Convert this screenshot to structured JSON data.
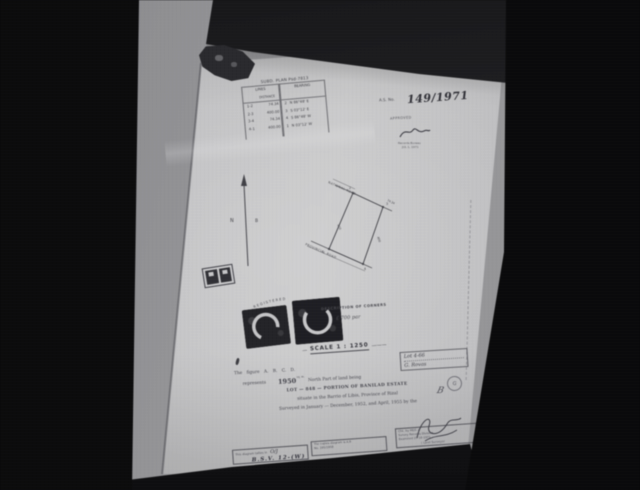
{
  "colors": {
    "paper": "#c2c2c4",
    "backdrop": "#8f8f92",
    "ink": "#3a3a40",
    "photo_black": "#060607",
    "seal_ink": "#1d1d21"
  },
  "table": {
    "title": "SUBD. PLAN Psd-7813",
    "group_headers": [
      "LINES",
      "BEARING"
    ],
    "sub_header": "DISTANCE",
    "rows": [
      {
        "line": "1-2",
        "distance": "74.34",
        "n": "2",
        "bearing": "N 86°48' E"
      },
      {
        "line": "2-3",
        "distance": "400.00",
        "n": "3",
        "bearing": "S 03°12' E"
      },
      {
        "line": "3-4",
        "distance": "74.34",
        "n": "4",
        "bearing": "S 86°48' W"
      },
      {
        "line": "4-1",
        "distance": "400.00",
        "n": "1",
        "bearing": "N 03°12' W"
      }
    ]
  },
  "approval": {
    "as_label": "A.S. No.",
    "as_number": "149/1971",
    "approved": "APPROVED",
    "bureau": "Records Bureau",
    "date": "JUL 1, 1971"
  },
  "north": {
    "left_mark": "N",
    "right_mark": "B"
  },
  "parcel": {
    "road_top": "NATIONAL ROAD",
    "road_bottom": "PROVINCIAL ROAD",
    "side_left": "400",
    "side_right": "400",
    "top_width": "74.34",
    "corners": {
      "tl": "2",
      "tr": "3",
      "bl": "1",
      "br": "4"
    }
  },
  "seals": {
    "arc_text": "REGISTERED"
  },
  "description": {
    "heading": "DESCRIPTION OF CORNERS",
    "note": "£ 700 par"
  },
  "scale": {
    "dash_left": "—",
    "text": "SCALE 1 : 1250",
    "dash_right": "———"
  },
  "lot_box": {
    "line1": "Lot  4-66",
    "line2": "G. Rovas"
  },
  "body": {
    "l1": "The figure  A. B. C. D.",
    "l2_pre": "represents",
    "l2_area": "1950",
    "l2_sup": "sq. m.",
    "l2_post": "North Part of land being",
    "l3": "LOT — 848 — PORTION OF BANILAD ESTATE",
    "l4": "situate in the Barrio of Libis, Province of Rizal",
    "l5": "Surveyed in January — December, 1952, and April, 1955 by the"
  },
  "signatures": {
    "surveyor_caption": "( Land Surveyor",
    "round_stamp_letter": "G",
    "hand_initial": "B"
  },
  "footer": {
    "box1_l1": "This diagram tallies in",
    "box1_mark": "O/J",
    "box1_hand": "B.S.V. 12-(W)",
    "box2_l1": "The copies diagram is A.B",
    "box2_l2": "No. 195/1958",
    "box3_l1": "Chk. by  MGS ✓",
    "box3_l2": "Survey Records Division",
    "box3_l3": "Examined  27-10-1971"
  }
}
